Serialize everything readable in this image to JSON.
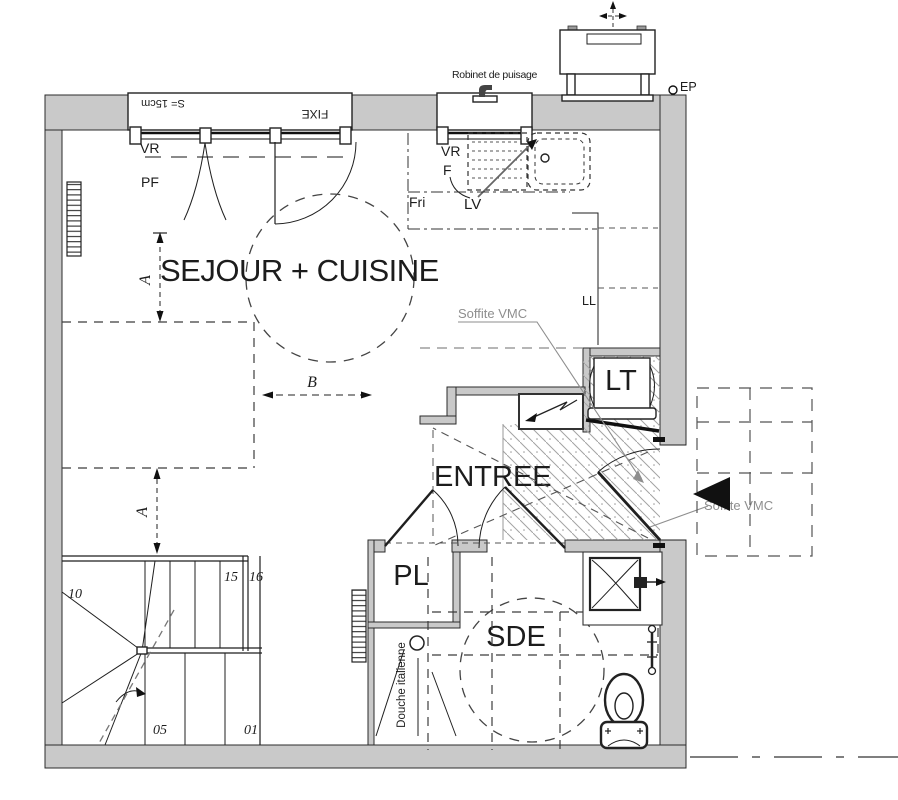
{
  "rooms": {
    "sejour_cuisine": "SEJOUR + CUISINE",
    "entree": "ENTREE",
    "sde": "SDE",
    "pl": "PL",
    "lt": "LT"
  },
  "windows": {
    "fixe": "FIXE",
    "shutter_depth": "S= 15cm",
    "vr": "VR",
    "pf": "PF"
  },
  "kitchen": {
    "vr": "VR",
    "f": "F",
    "fri": "Fri",
    "lv": "LV",
    "ll": "LL",
    "robinet": "Robinet de puisage"
  },
  "entry": {
    "soffite_vmc_1": "Soffite VMC",
    "soffite_vmc_2": "Soffite VMC"
  },
  "bathroom": {
    "douche_italienne": "Douche italienne"
  },
  "dimensions": {
    "a_upper": "A",
    "a_lower": "A",
    "b": "B"
  },
  "stair_numbers": {
    "n10": "10",
    "n15": "15",
    "n16": "16",
    "n05": "05",
    "n01": "01"
  },
  "site": {
    "ep": "EP"
  },
  "colors": {
    "wall_fill": "#c9c9c9",
    "line": "#1f1f1f",
    "hatch": "#9a9a9a",
    "soffite_text": "#8e8e8e"
  }
}
